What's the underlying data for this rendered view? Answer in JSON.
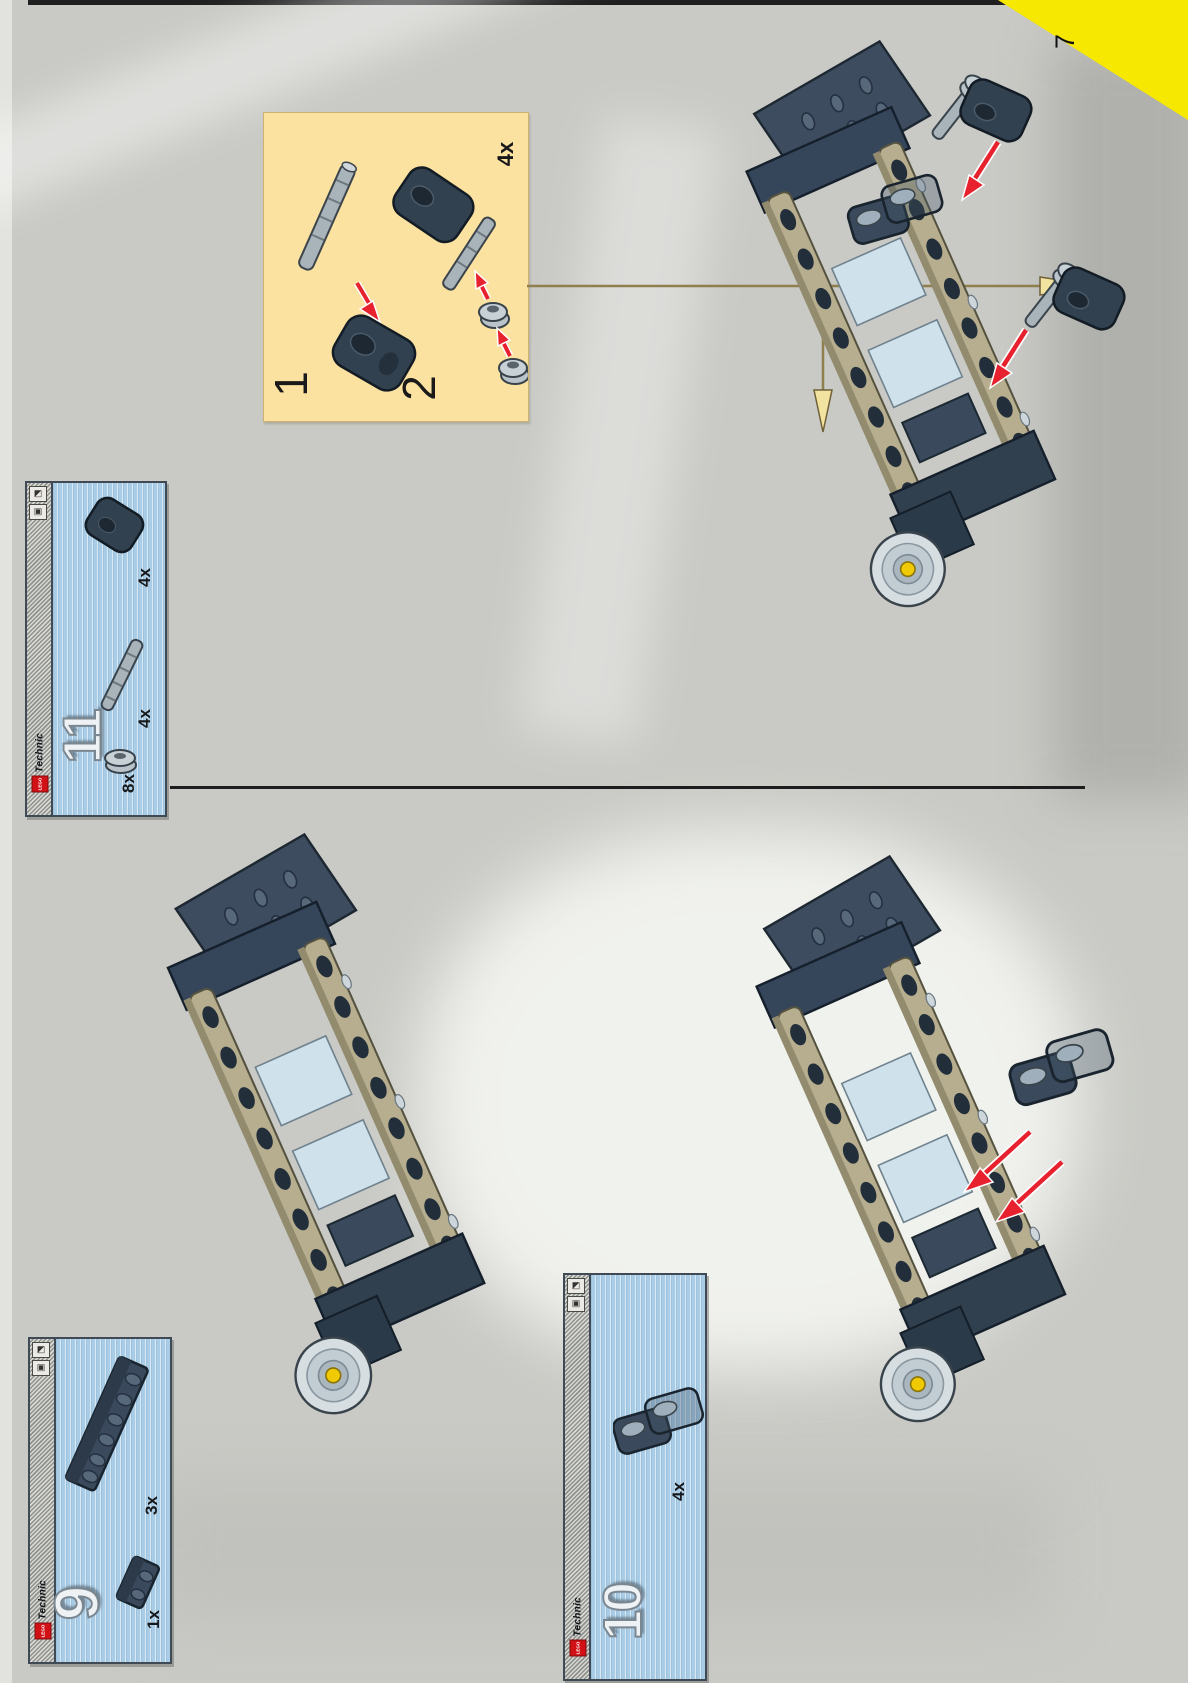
{
  "page": {
    "number": "7",
    "type": "lego-technic-instruction-page"
  },
  "callout_box": {
    "substeps": [
      {
        "label": "1",
        "shows": "axle-inserted-into-angle-connector"
      },
      {
        "label": "2",
        "shows": "two-bushes-pushed-onto-axle"
      }
    ],
    "quantity": "4x"
  },
  "parts_boxes": {
    "step11": {
      "step_number": "11",
      "logo": "LEGO",
      "brand": "Technic",
      "parts": [
        {
          "name": "angle-connector",
          "qty": "4x"
        },
        {
          "name": "axle",
          "qty": "4x"
        },
        {
          "name": "bush",
          "qty": "8x"
        }
      ]
    },
    "step9": {
      "step_number": "9",
      "logo": "LEGO",
      "brand": "Technic",
      "parts": [
        {
          "name": "brick-1x6",
          "qty": "3x"
        },
        {
          "name": "brick-1x2",
          "qty": "1x"
        }
      ]
    },
    "step10": {
      "step_number": "10",
      "logo": "LEGO",
      "brand": "Technic",
      "parts": [
        {
          "name": "catch-connector",
          "qty": "4x"
        }
      ]
    }
  },
  "icons": {
    "edge_pictogram_a": "◩",
    "edge_pictogram_b": "▣"
  },
  "colors": {
    "page_tab_yellow": "#f6e800",
    "callout_yellow": "#fbe2a1",
    "parts_box_blue": "#a9cde6",
    "arrow_red": "#e8212e",
    "guide_arrow_tan": "#8f7f4f",
    "beam_tan": "#b6ae8e",
    "dark_part": "#36465a",
    "hub_yellow": "#f0cb05"
  }
}
